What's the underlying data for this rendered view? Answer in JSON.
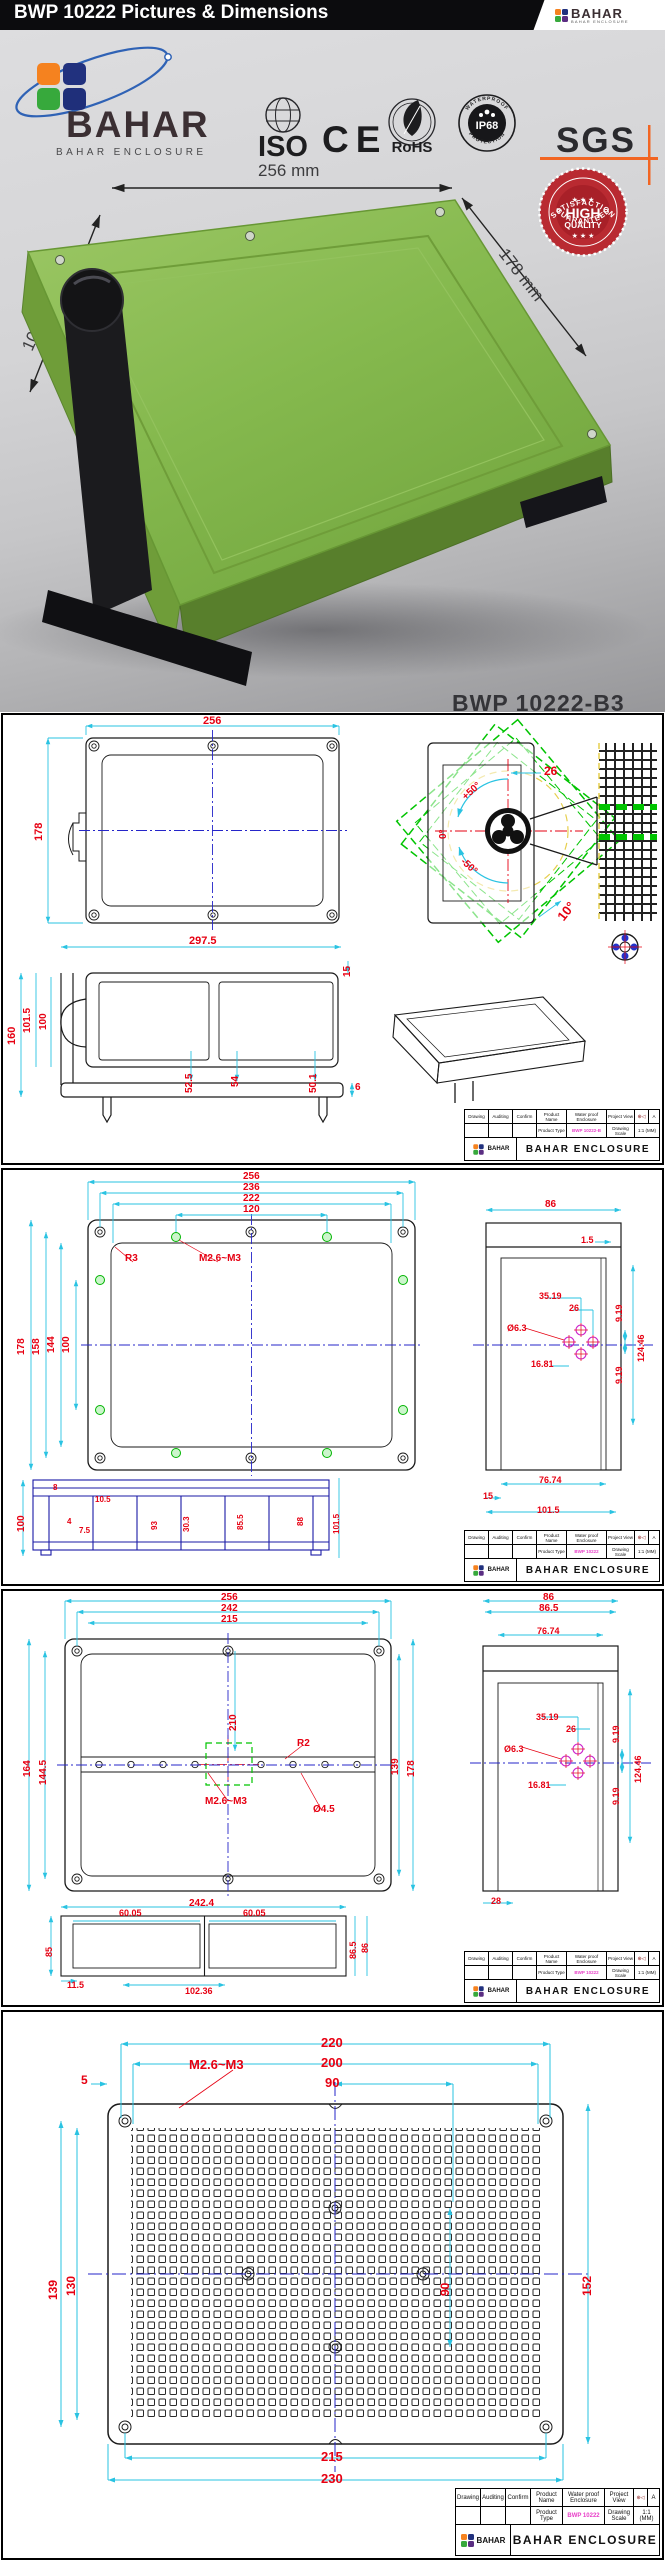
{
  "header": {
    "title": "BWP 10222 Pictures & Dimensions",
    "brand": "BAHAR",
    "brand_sub": "BAHAR ENCLOSURE"
  },
  "photo": {
    "brand": "BAHAR",
    "brand_sub": "BAHAR ENCLOSURE",
    "dim_width": "256 mm",
    "dim_height": "100 mm",
    "dim_depth": "178 mm",
    "model": "BWP 10222-B3",
    "certs": {
      "iso": "ISO",
      "ce": "CE",
      "rohs": "RoHS",
      "ip68": "IP68",
      "ip68_top": "WATERPROOF",
      "ip68_bottom": "PROTECTION",
      "sgs": "SGS"
    },
    "badge": {
      "arc_top": "SATISFACTION",
      "stars": "★ ★ ★",
      "line1": "HIGH",
      "line2": "QUALITY",
      "arc_bottom": "GUARANTEED"
    }
  },
  "titleblock": {
    "drawing": "Drawing",
    "auditing": "Auditing",
    "confirm": "Confirm",
    "product_name": "Product Name",
    "product_name_value": "Water proof Enclosure",
    "project_view": "Project View",
    "projection_icon": "first-angle-projection",
    "rev": "A",
    "product_type": "Product Type",
    "drawing_scale": "Drawing Scale",
    "scale_value": "1:1 (MM)",
    "company": "BAHAR ENCLOSURE"
  },
  "colors": {
    "dim_red": "#e60012",
    "dim_cyan": "#2ac3e2",
    "centerline_blue": "#2626c9",
    "rotation_green": "#00c400",
    "hole_magenta": "#cc22cc",
    "section_blue": "#1a1aa6",
    "enclosure_green": "#85b94e",
    "badge_red": "#b92a31",
    "sgs_orange": "#f26522",
    "product_code_magenta": "#e83ec8"
  },
  "panels": [
    {
      "name": "overview-and-mounting-drawing",
      "product_type": "BWP 10222-B",
      "annotations": [
        {
          "t": "256",
          "x": 200,
          "y": 1,
          "s": 11
        },
        {
          "t": "178",
          "x": 31,
          "y": 126,
          "r": -90,
          "s": 11
        },
        {
          "t": "26",
          "x": 541,
          "y": 50,
          "s": 12
        },
        {
          "t": "+50°",
          "x": 458,
          "y": 80,
          "r": -42,
          "s": 10
        },
        {
          "t": "0°",
          "x": 436,
          "y": 124,
          "r": -90,
          "s": 10
        },
        {
          "t": "-50°",
          "x": 462,
          "y": 142,
          "r": 42,
          "s": 10
        },
        {
          "t": "10°",
          "x": 552,
          "y": 200,
          "r": -52,
          "s": 13
        },
        {
          "t": "297.5",
          "x": 186,
          "y": 221,
          "s": 11
        },
        {
          "t": "15",
          "x": 340,
          "y": 262,
          "r": -90,
          "s": 10
        },
        {
          "t": "160",
          "x": 4,
          "y": 330,
          "r": -90,
          "s": 11
        },
        {
          "t": "101.5",
          "x": 20,
          "y": 318,
          "r": -90,
          "s": 10
        },
        {
          "t": "100",
          "x": 36,
          "y": 315,
          "r": -90,
          "s": 10
        },
        {
          "t": "52.5",
          "x": 182,
          "y": 378,
          "r": -90,
          "s": 10
        },
        {
          "t": "54",
          "x": 228,
          "y": 372,
          "r": -90,
          "s": 10
        },
        {
          "t": "50.1",
          "x": 306,
          "y": 378,
          "r": -90,
          "s": 10
        },
        {
          "t": "6",
          "x": 352,
          "y": 368,
          "s": 10
        }
      ]
    },
    {
      "name": "lid-top-view-and-section-drawing",
      "product_type": "BWP 10222",
      "annotations": [
        {
          "t": "256",
          "x": 240,
          "y": 2,
          "s": 10
        },
        {
          "t": "236",
          "x": 240,
          "y": 13,
          "s": 10
        },
        {
          "t": "222",
          "x": 240,
          "y": 24,
          "s": 10
        },
        {
          "t": "120",
          "x": 240,
          "y": 35,
          "s": 10
        },
        {
          "t": "R3",
          "x": 122,
          "y": 84,
          "s": 10
        },
        {
          "t": "M2.6~M3",
          "x": 196,
          "y": 84,
          "s": 10
        },
        {
          "t": "178",
          "x": 14,
          "y": 185,
          "r": -90,
          "s": 10
        },
        {
          "t": "158",
          "x": 29,
          "y": 185,
          "r": -90,
          "s": 10
        },
        {
          "t": "144",
          "x": 44,
          "y": 183,
          "r": -90,
          "s": 10
        },
        {
          "t": "100",
          "x": 59,
          "y": 183,
          "r": -90,
          "s": 10
        },
        {
          "t": "86",
          "x": 542,
          "y": 30,
          "s": 10
        },
        {
          "t": "1.5",
          "x": 578,
          "y": 66,
          "s": 9
        },
        {
          "t": "35.19",
          "x": 536,
          "y": 122,
          "s": 9
        },
        {
          "t": "26",
          "x": 566,
          "y": 134,
          "s": 9
        },
        {
          "t": "9.19",
          "x": 612,
          "y": 152,
          "r": -90,
          "s": 9
        },
        {
          "t": "Ø6.3",
          "x": 504,
          "y": 154,
          "s": 9
        },
        {
          "t": "124.46",
          "x": 634,
          "y": 192,
          "r": -90,
          "s": 9
        },
        {
          "t": "16.81",
          "x": 528,
          "y": 190,
          "s": 9
        },
        {
          "t": "9.19",
          "x": 612,
          "y": 214,
          "r": -90,
          "s": 9
        },
        {
          "t": "76.74",
          "x": 536,
          "y": 306,
          "s": 9
        },
        {
          "t": "15",
          "x": 480,
          "y": 322,
          "s": 9
        },
        {
          "t": "101.5",
          "x": 534,
          "y": 336,
          "s": 9
        },
        {
          "t": "100",
          "x": 14,
          "y": 362,
          "r": -90,
          "s": 10
        },
        {
          "t": "8",
          "x": 50,
          "y": 314,
          "s": 8
        },
        {
          "t": "4",
          "x": 64,
          "y": 348,
          "s": 8
        },
        {
          "t": "7.5",
          "x": 76,
          "y": 357,
          "s": 8
        },
        {
          "t": "10.5",
          "x": 92,
          "y": 326,
          "s": 8
        },
        {
          "t": "93",
          "x": 148,
          "y": 360,
          "r": -90,
          "s": 8
        },
        {
          "t": "30.3",
          "x": 180,
          "y": 362,
          "r": -90,
          "s": 8
        },
        {
          "t": "85.5",
          "x": 234,
          "y": 360,
          "r": -90,
          "s": 8
        },
        {
          "t": "88",
          "x": 294,
          "y": 356,
          "r": -90,
          "s": 8
        },
        {
          "t": "101.5",
          "x": 330,
          "y": 364,
          "r": -90,
          "s": 8
        }
      ]
    },
    {
      "name": "base-top-view-and-section-drawing",
      "product_type": "BWP 10222",
      "annotations": [
        {
          "t": "256",
          "x": 218,
          "y": 2,
          "s": 10
        },
        {
          "t": "242",
          "x": 218,
          "y": 13,
          "s": 10
        },
        {
          "t": "215",
          "x": 218,
          "y": 24,
          "s": 10
        },
        {
          "t": "210",
          "x": 226,
          "y": 140,
          "r": -90,
          "s": 10
        },
        {
          "t": "R2",
          "x": 294,
          "y": 148,
          "s": 10
        },
        {
          "t": "M2.6~M3",
          "x": 202,
          "y": 206,
          "s": 10
        },
        {
          "t": "Ø4.5",
          "x": 310,
          "y": 214,
          "s": 10
        },
        {
          "t": "164",
          "x": 20,
          "y": 186,
          "r": -90,
          "s": 10
        },
        {
          "t": "144.5",
          "x": 36,
          "y": 194,
          "r": -90,
          "s": 10
        },
        {
          "t": "139",
          "x": 388,
          "y": 184,
          "r": -90,
          "s": 10
        },
        {
          "t": "178",
          "x": 404,
          "y": 186,
          "r": -90,
          "s": 10
        },
        {
          "t": "242.4",
          "x": 186,
          "y": 308,
          "s": 10
        },
        {
          "t": "60.05",
          "x": 116,
          "y": 318,
          "s": 9
        },
        {
          "t": "60.05",
          "x": 240,
          "y": 318,
          "s": 9
        },
        {
          "t": "85",
          "x": 42,
          "y": 366,
          "r": -90,
          "s": 9
        },
        {
          "t": "86.5",
          "x": 346,
          "y": 368,
          "r": -90,
          "s": 9
        },
        {
          "t": "86",
          "x": 358,
          "y": 362,
          "r": -90,
          "s": 9
        },
        {
          "t": "11.5",
          "x": 64,
          "y": 390,
          "s": 9
        },
        {
          "t": "102.36",
          "x": 182,
          "y": 396,
          "s": 9
        },
        {
          "t": "86",
          "x": 540,
          "y": 2,
          "s": 10
        },
        {
          "t": "86.5",
          "x": 536,
          "y": 13,
          "s": 10
        },
        {
          "t": "76.74",
          "x": 534,
          "y": 36,
          "s": 9
        },
        {
          "t": "35.19",
          "x": 533,
          "y": 122,
          "s": 9
        },
        {
          "t": "26",
          "x": 563,
          "y": 134,
          "s": 9
        },
        {
          "t": "9.19",
          "x": 609,
          "y": 152,
          "r": -90,
          "s": 9
        },
        {
          "t": "Ø6.3",
          "x": 501,
          "y": 154,
          "s": 9
        },
        {
          "t": "124.46",
          "x": 631,
          "y": 192,
          "r": -90,
          "s": 9
        },
        {
          "t": "16.81",
          "x": 525,
          "y": 190,
          "s": 9
        },
        {
          "t": "9.19",
          "x": 609,
          "y": 214,
          "r": -90,
          "s": 9
        },
        {
          "t": "28",
          "x": 488,
          "y": 306,
          "s": 9
        }
      ]
    },
    {
      "name": "mounting-plate-drawing",
      "product_type": "BWP 10222",
      "annotations": [
        {
          "t": "220",
          "x": 318,
          "y": 24,
          "s": 13
        },
        {
          "t": "200",
          "x": 318,
          "y": 44,
          "s": 13
        },
        {
          "t": "90",
          "x": 322,
          "y": 64,
          "s": 13
        },
        {
          "t": "M2.6~M3",
          "x": 186,
          "y": 46,
          "s": 13
        },
        {
          "t": "5",
          "x": 78,
          "y": 62,
          "s": 12
        },
        {
          "t": "139",
          "x": 44,
          "y": 288,
          "r": -90,
          "s": 12
        },
        {
          "t": "130",
          "x": 62,
          "y": 284,
          "r": -90,
          "s": 12
        },
        {
          "t": "90",
          "x": 436,
          "y": 284,
          "r": -90,
          "s": 12
        },
        {
          "t": "152",
          "x": 578,
          "y": 284,
          "r": -90,
          "s": 12
        },
        {
          "t": "215",
          "x": 318,
          "y": 438,
          "s": 13
        },
        {
          "t": "230",
          "x": 318,
          "y": 460,
          "s": 13
        }
      ]
    }
  ]
}
